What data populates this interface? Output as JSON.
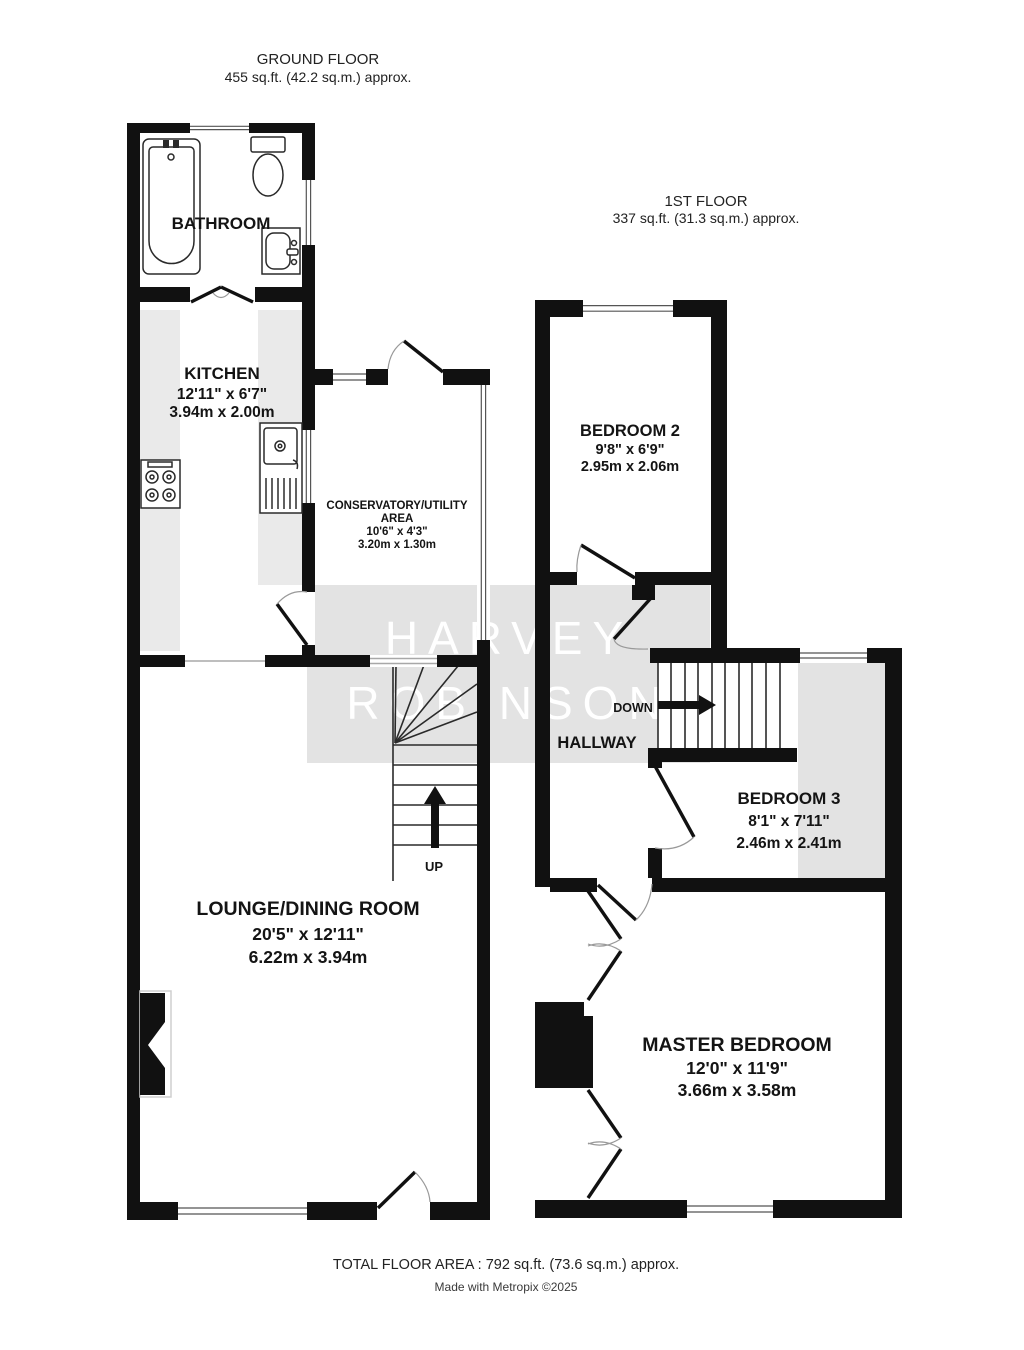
{
  "ground_floor": {
    "header_title": "GROUND FLOOR",
    "header_area": "455 sq.ft. (42.2 sq.m.) approx.",
    "bathroom": {
      "name": "BATHROOM"
    },
    "kitchen": {
      "name": "KITCHEN",
      "size_imperial": "12'11\"  x 6'7\"",
      "size_metric": "3.94m  x 2.00m"
    },
    "conservatory": {
      "name_line1": "CONSERVATORY/UTILITY",
      "name_line2": "AREA",
      "size_imperial": "10'6\"  x 4'3\"",
      "size_metric": "3.20m  x 1.30m"
    },
    "lounge": {
      "name": "LOUNGE/DINING ROOM",
      "size_imperial": "20'5\"  x 12'11\"",
      "size_metric": "6.22m  x 3.94m"
    },
    "stairs_label": "UP"
  },
  "first_floor": {
    "header_title": "1ST FLOOR",
    "header_area": "337 sq.ft. (31.3 sq.m.) approx.",
    "bedroom2": {
      "name": "BEDROOM 2",
      "size_imperial": "9'8\"  x 6'9\"",
      "size_metric": "2.95m  x 2.06m"
    },
    "bedroom3": {
      "name": "BEDROOM 3",
      "size_imperial": "8'1\"  x 7'11\"",
      "size_metric": "2.46m  x 2.41m"
    },
    "master_bedroom": {
      "name": "MASTER BEDROOM",
      "size_imperial": "12'0\"  x 11'9\"",
      "size_metric": "3.66m  x 3.58m"
    },
    "hallway": {
      "name": "HALLWAY"
    },
    "stairs_label": "DOWN"
  },
  "watermark": {
    "line1": "HARVEY",
    "line2": "ROBINSON"
  },
  "footer": {
    "total_area": "TOTAL FLOOR AREA : 792 sq.ft. (73.6 sq.m.) approx.",
    "credit": "Made with Metropix ©2025"
  },
  "colors": {
    "wall": "#111111",
    "shading_band": "#e3e3e3",
    "counter": "#eaeaea",
    "text": "#141414",
    "watermark_text": "#ffffff"
  }
}
